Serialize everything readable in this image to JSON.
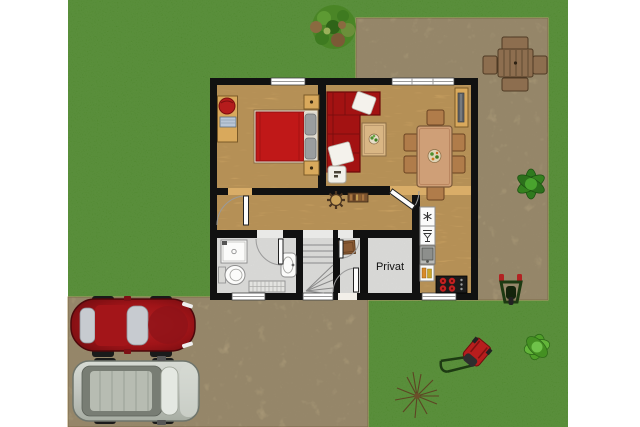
{
  "image": {
    "width": 640,
    "height": 427,
    "kind": "house-floor-plan-with-garden-top-view"
  },
  "labels": {
    "privat_room": "Privat"
  },
  "palette": {
    "page_bg": "#ffffff",
    "grass": "#58a22e",
    "stone": "#d7c298",
    "stone_edge": "#b59c6e",
    "wood": "#d9ad68",
    "tile": "#e9e9e7",
    "wall": "#111111",
    "window_white": "#ffffff",
    "sofa_red": "#a31212",
    "bed_red": "#c01818",
    "car_red": "#a01418",
    "van_gray": "#c2c6c0",
    "wood_furniture": "#d9a95c",
    "patio_wood": "#8d6e4f",
    "plant_green": "#2f7a1e",
    "stove_black": "#1b1b1b",
    "burner_red": "#c32020",
    "text_color": "#111111"
  },
  "house": {
    "rooms": [
      {
        "name": "bedroom"
      },
      {
        "name": "living-dining-room"
      },
      {
        "name": "kitchen"
      },
      {
        "name": "hallway"
      },
      {
        "name": "bathroom"
      },
      {
        "name": "staircase"
      },
      {
        "name": "entrance-vestibule"
      },
      {
        "name": "private-room",
        "label": "Privat"
      }
    ],
    "furniture": [
      "double-bed",
      "nightstands",
      "desk-with-chair",
      "corner-sofa",
      "coffee-table",
      "ottoman",
      "dining-table-six-chairs",
      "sideboard",
      "wall-clock-sun",
      "wall-shelf",
      "shower",
      "toilet",
      "wash-basin",
      "radiator",
      "freezer",
      "dishwasher",
      "kitchen-sink",
      "bottle-cabinet",
      "stove",
      "stairs",
      "doormat"
    ]
  },
  "garden": {
    "items": [
      "tree",
      "patio-table-with-four-chairs",
      "green-plant",
      "wheelbarrow",
      "lawn-mower",
      "green-bush",
      "dry-shrub",
      "red-car",
      "gray-van",
      "stone-patio",
      "stone-driveway"
    ]
  }
}
